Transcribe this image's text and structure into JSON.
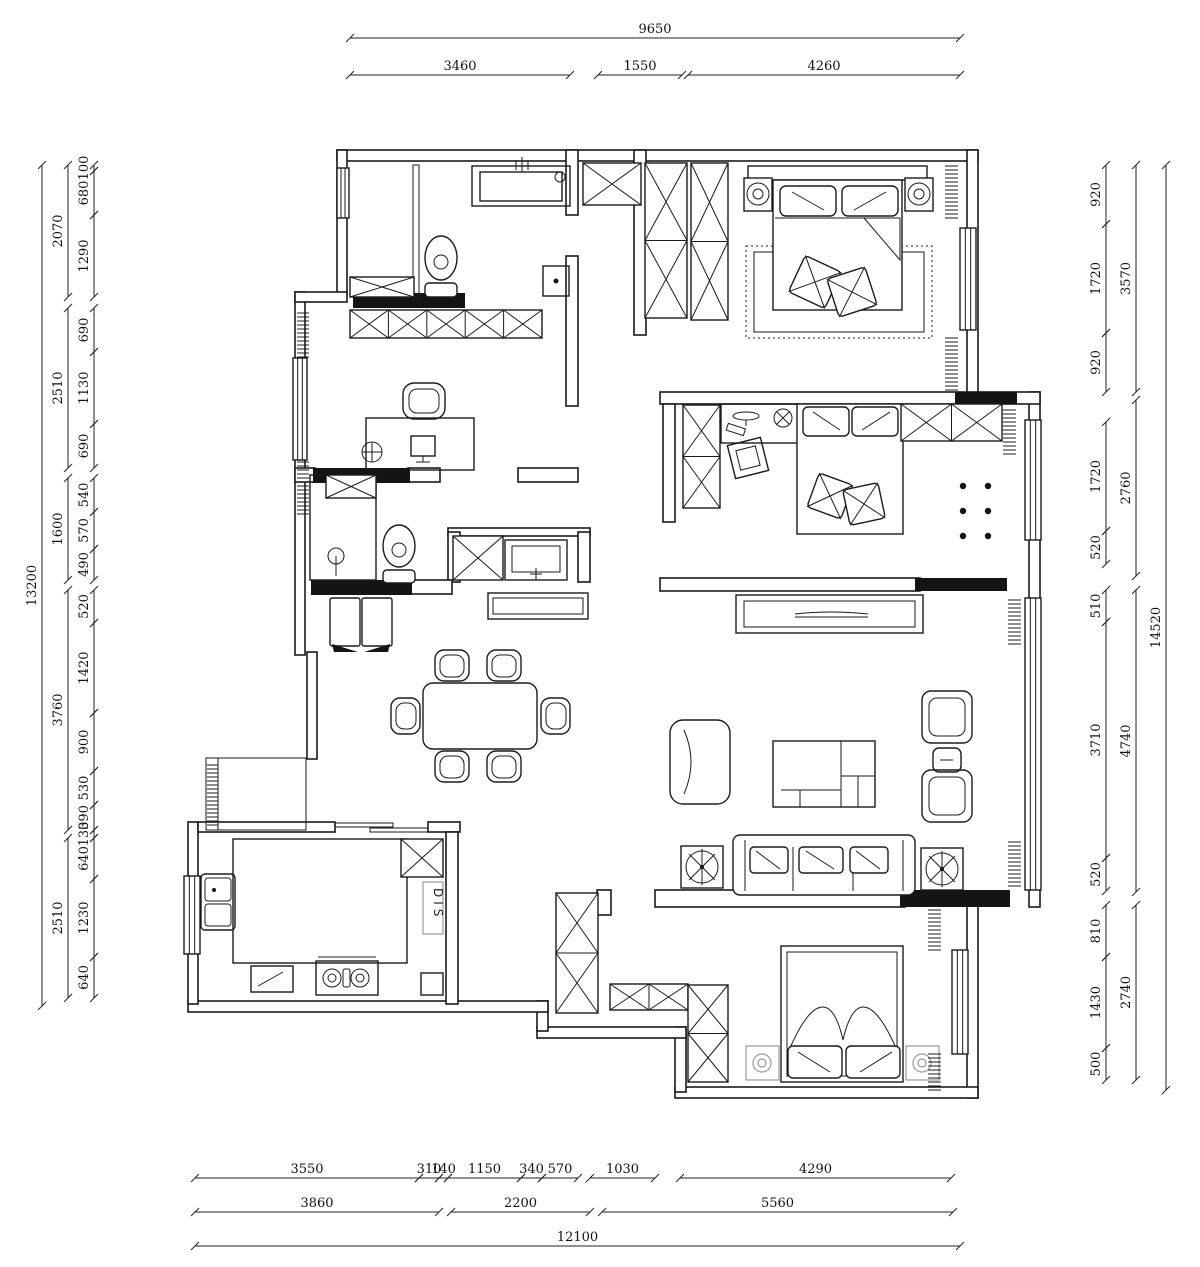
{
  "labels": {
    "dishwasher_cabinet": "DIS"
  },
  "dimensions": {
    "top": {
      "total": "9650",
      "row": [
        "3460",
        "1550",
        "4260"
      ]
    },
    "bottom": {
      "row1": [
        "3550",
        "310",
        "140",
        "1150",
        "340",
        "570",
        "1030",
        "4290"
      ],
      "row2": [
        "3860",
        "2200",
        "5560"
      ],
      "total": "12100"
    },
    "left": {
      "total": "13200",
      "groups": [
        "2070",
        "2510",
        "1600",
        "3760",
        "2510"
      ],
      "segments": [
        "100",
        "680",
        "1290",
        "690",
        "1130",
        "690",
        "540",
        "570",
        "490",
        "520",
        "1420",
        "900",
        "530",
        "390",
        "130",
        "640",
        "1230",
        "640"
      ]
    },
    "right": {
      "total": "14520",
      "groups": [
        "3570",
        "2760",
        "4740",
        "2740"
      ],
      "segments": [
        "920",
        "1720",
        "920",
        "1720",
        "520",
        "510",
        "3710",
        "520",
        "810",
        "1430",
        "500"
      ]
    }
  }
}
